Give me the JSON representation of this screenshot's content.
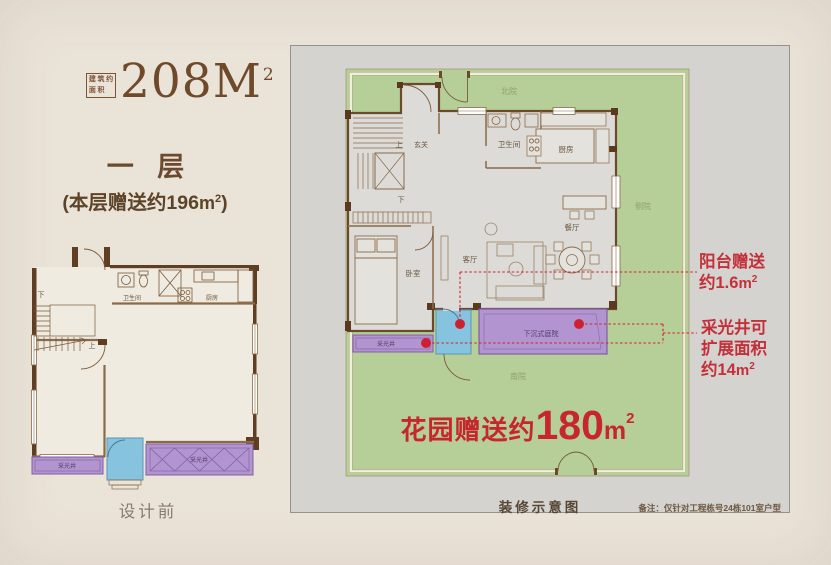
{
  "colors": {
    "accent_red": "#c6262e",
    "garden_green": "#b6cf98",
    "lightwell_purple": "#b294d0",
    "balcony_blue": "#85c3de",
    "wall_brown": "#5f3e23",
    "panel_gray": "#d4d3cf",
    "page_beige": "#eae3d8"
  },
  "header": {
    "area_box_chars": [
      "建",
      "筑",
      "约",
      "面",
      "积"
    ],
    "area_value": "208M",
    "area_sup": "2",
    "floor_label": "一 层",
    "bonus_text": "(本层赠送约196",
    "bonus_unit": "m",
    "bonus_sup": "2",
    "bonus_close": ")"
  },
  "left_plan": {
    "caption": "设计前",
    "labels": {
      "down": "下",
      "up": "上",
      "bath": "卫生间",
      "kitchen": "厨房",
      "lightwell_left": "采光井",
      "lightwell_right": "采光井"
    }
  },
  "right_plan": {
    "caption": "装修示意图",
    "note": "备注：仅针对工程栋号24栋101室户型",
    "yards": {
      "north": "北院",
      "side": "侧院",
      "south": "南院"
    },
    "rooms": {
      "up": "上",
      "entry": "玄关",
      "down": "下",
      "bath": "卫生间",
      "kitchen": "厨房",
      "living": "客厅",
      "dining": "餐厅",
      "bedroom": "卧室",
      "lightwell": "采光井",
      "sunken_courtyard": "下沉式庭院"
    },
    "garden_banner": {
      "label": "花园赠送约",
      "value": "180",
      "unit": "m",
      "sup": "2"
    },
    "ann_balcony": {
      "line1": "阳台赠送",
      "line2": "约1.6",
      "unit": "m",
      "sup": "2"
    },
    "ann_lightwell": {
      "line1": "采光井可",
      "line2": "扩展面积",
      "line3": "约14",
      "unit": "m",
      "sup": "2"
    }
  }
}
